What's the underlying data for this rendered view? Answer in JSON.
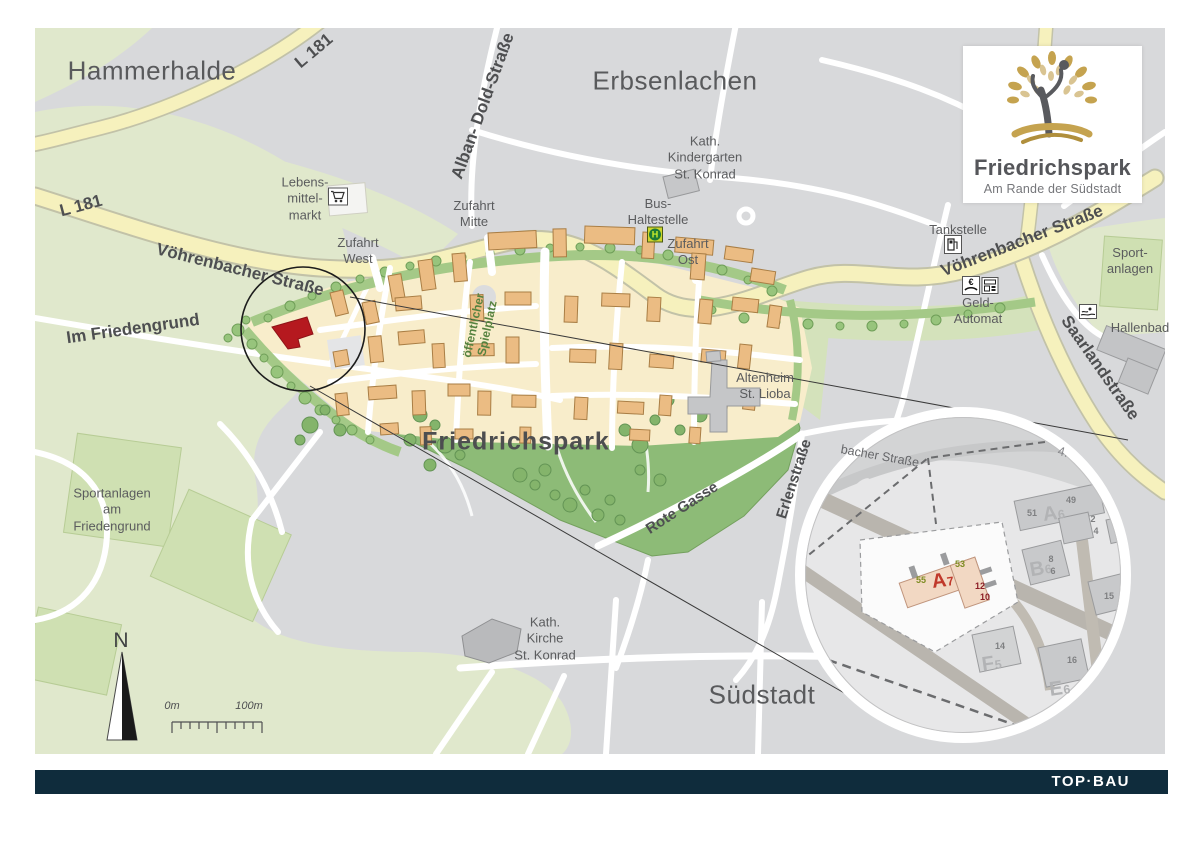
{
  "page": {
    "footer_brand": "TOP·BAU"
  },
  "logo": {
    "title": "Friedrichspark",
    "subtitle": "Am Rande der Südstadt"
  },
  "districts": {
    "hammerhalde": "Hammerhalde",
    "erbsenlachen": "Erbsenlachen",
    "suedstadt": "Südstadt"
  },
  "park": {
    "name": "Friedrichspark",
    "playground": "öffentlicher\nSpielplatz"
  },
  "roads": {
    "l181": "L 181",
    "voehrenbacher": "Vöhrenbacher Straße",
    "alban_dold": "Alban- Dold-Straße",
    "saarlandstrasse": "Saarlandstraße",
    "im_friedengrund": "Im Friedengrund",
    "erlenstrasse": "Erlenstraße",
    "rote_gasse": "Rote Gasse"
  },
  "pois": {
    "kindergarten": "Kath.\nKindergarten\nSt. Konrad",
    "supermarket": "Lebens-\nmittel-\nmarkt",
    "zufahrt_west": "Zufahrt\nWest",
    "zufahrt_mitte": "Zufahrt\nMitte",
    "zufahrt_ost": "Zufahrt\nOst",
    "bus_stop": "Bus-\nHaltestelle",
    "tankstelle": "Tankstelle",
    "geldautomat": "Geld-\nAutomat",
    "sportanlagen_ost": "Sport-\nanlagen",
    "hallenbad": "Hallenbad",
    "altenheim": "Altenheim\nSt. Lioba",
    "sportanlagen_west": "Sportanlagen\nam\nFriedengrund",
    "kirche": "Kath.\nKirche\nSt. Konrad"
  },
  "compass": {
    "north": "N"
  },
  "scalebar": {
    "start": "0m",
    "end": "100m"
  },
  "inset": {
    "street": "bacher Straße",
    "section": "4.",
    "buildings": {
      "a7": {
        "letter": "A",
        "num": "7"
      },
      "a6": {
        "letter": "A",
        "num": "6"
      },
      "b6": {
        "letter": "B",
        "num": "6"
      },
      "f5": {
        "letter": "F",
        "num": "5"
      },
      "e6": {
        "letter": "E",
        "num": "6"
      }
    },
    "numbers": {
      "n55": "55",
      "n53": "53",
      "n12": "12",
      "n10": "10",
      "n51": "51",
      "n49": "49",
      "n2": "2",
      "n4": "4",
      "n8": "8",
      "n6": "6",
      "n15": "15",
      "n14": "14",
      "n16": "16"
    }
  },
  "colors": {
    "accent_red": "#b5191f",
    "navy": "#0f2c3c",
    "gold": "#c5a34f",
    "park_green": "#8dbb77",
    "road_yellow": "#f6f1bd"
  }
}
